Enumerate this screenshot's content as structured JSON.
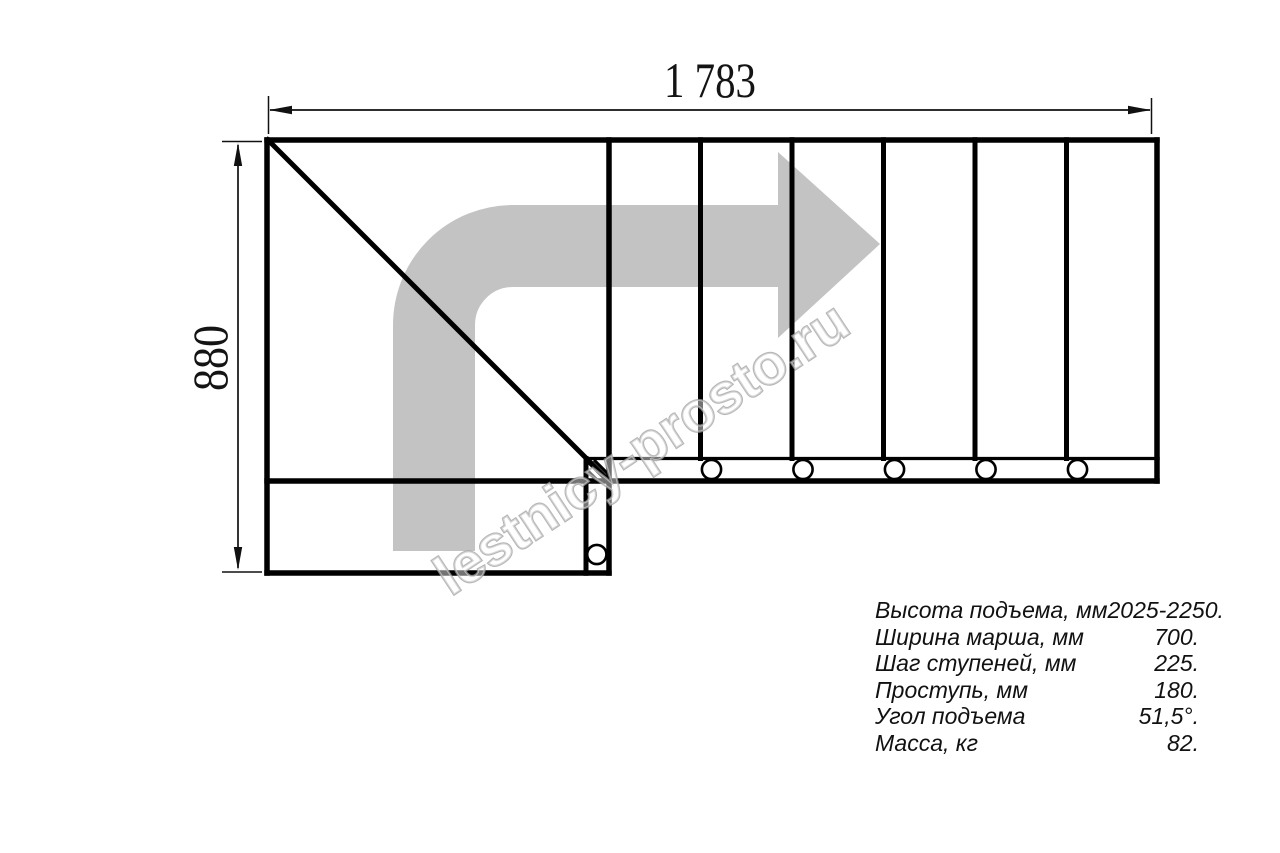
{
  "drawing": {
    "watermark": "lestnicy-prosto.ru",
    "dimensions": {
      "width_label": "1 783",
      "height_label": "880"
    },
    "colors": {
      "arrow": "#c3c3c3",
      "line": "#000000",
      "watermark": "#9e9e9e",
      "dim_text": "#141414"
    }
  },
  "specs": {
    "rows": [
      {
        "label": "Высота подъема, мм",
        "value": "2025-2250."
      },
      {
        "label": "Ширина марша, мм",
        "value": "700."
      },
      {
        "label": "Шаг ступеней, мм",
        "value": "225."
      },
      {
        "label": "Проступь, мм",
        "value": "180."
      },
      {
        "label": "Угол подъема",
        "value": "51,5°."
      },
      {
        "label": "Масса, кг",
        "value": "82."
      }
    ]
  }
}
